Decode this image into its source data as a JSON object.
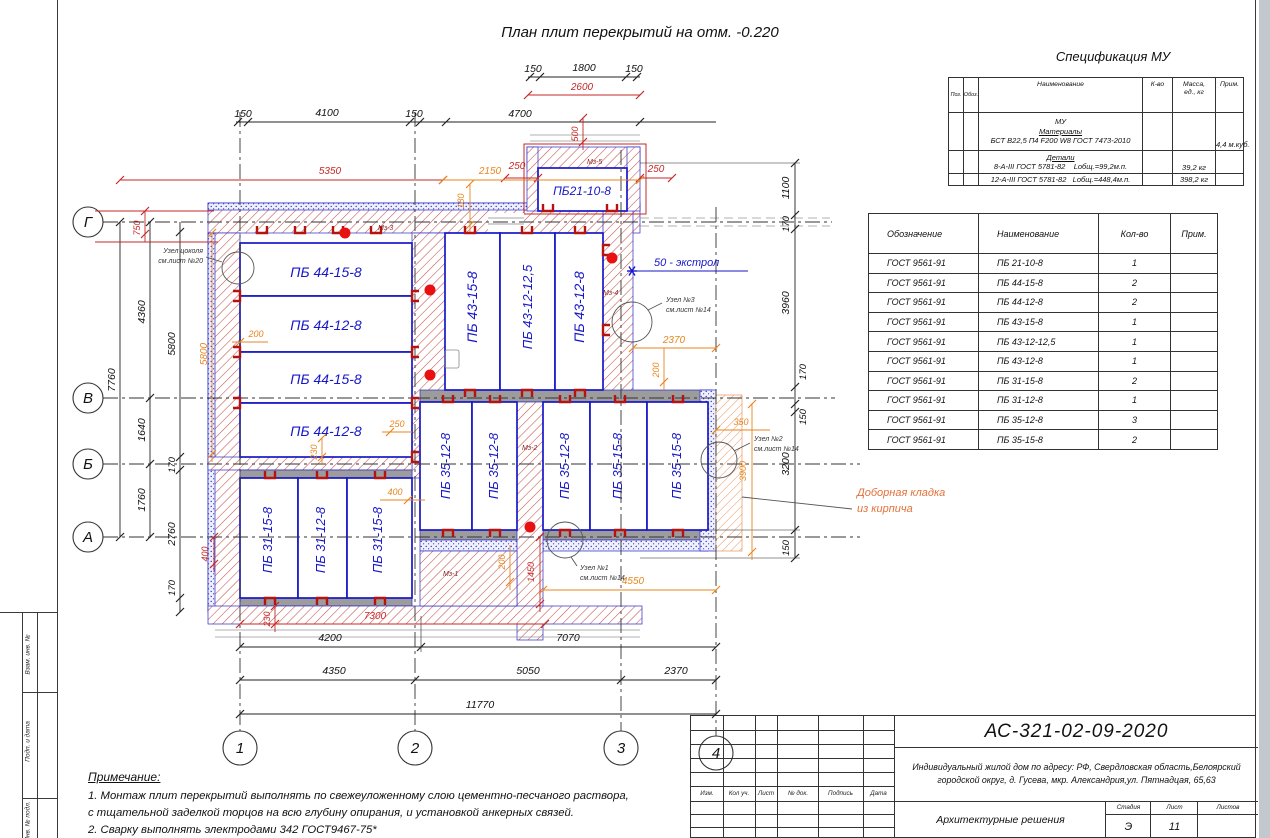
{
  "sheet": {
    "plan_title": "План плит перекрытий на отм. -0.220",
    "spec_title": "Спецификация МУ"
  },
  "colors": {
    "slab_blue": "#1717c9",
    "hatch_red": "#c4524a",
    "dim_red": "#c62828",
    "dim_orange": "#e8861e",
    "masonry_gray": "#9c9c9c"
  },
  "axes": {
    "h": [
      "Г",
      "В",
      "Б",
      "А"
    ],
    "v": [
      "1",
      "2",
      "3",
      "4"
    ]
  },
  "slabs": {
    "left": [
      "ПБ 44-15-8",
      "ПБ 44-12-8",
      "ПБ 44-15-8",
      "ПБ 44-12-8"
    ],
    "mid": [
      "ПБ 43-15-8",
      "ПБ 43-12-12,5",
      "ПБ 43-12-8"
    ],
    "top_bay": "ПБ21-10-8",
    "bottom_mid": [
      "ПБ 35-12-8",
      "ПБ 35-12-8",
      "ПБ 35-12-8",
      "ПБ 35-15-8",
      "ПБ 35-15-8"
    ],
    "bottom_left": [
      "ПБ 31-15-8",
      "ПБ 31-12-8",
      "ПБ 31-15-8"
    ]
  },
  "dims": {
    "bay150a": "150",
    "bay1800": "1800",
    "bay150b": "150",
    "bay2600": "2600",
    "bay500": "500",
    "m150a": "150",
    "m4100": "4100",
    "m150b": "150",
    "m4700": "4700",
    "red5350": "5350",
    "o2150": "2150",
    "red250a": "250",
    "red250b": "250",
    "o180": "180",
    "l7760": "7760",
    "l4360": "4360",
    "l1640": "1640",
    "l1760": "1760",
    "l5800": "5800",
    "l170a": "170",
    "l2760": "2760",
    "l170b": "170",
    "lo5800": "5800",
    "lr750": "750",
    "lr400": "400",
    "lo200": "200",
    "lo230": "230",
    "lo250": "250",
    "lo400": "400",
    "r1100": "1100",
    "r170a": "170",
    "r3960": "3960",
    "r170b": "170",
    "r150a": "150",
    "r3200": "3200",
    "r150b": "150",
    "ro2370": "2370",
    "ro200": "200",
    "ro350": "350",
    "ro3900": "3900",
    "rr250": "250",
    "br7300": "7300",
    "br230": "230",
    "br1450": "1450",
    "b4200": "4200",
    "b7070": "7070",
    "b4350": "4350",
    "b5050": "5050",
    "b2370": "2370",
    "b11770": "11770",
    "bo4550": "4550",
    "bo200": "200"
  },
  "ann": {
    "cokol1": "Узел цоколя",
    "cokol2": "см.лист №20",
    "n1a": "Узел №1",
    "n1b": "см.лист №14",
    "n2a": "Узел №2",
    "n2b": "см.лист №14",
    "n3a": "Узел №3",
    "n3b": "см.лист №14",
    "ekstrol": "50 - экстрол",
    "dob1": "Доборная кладка",
    "dob2": "из кирпича",
    "mz1": "Мз-1",
    "mz2": "Мз-2",
    "mz3": "Мз-3",
    "mz4": "Мз-4",
    "mz5": "Мз-5"
  },
  "spec_table": {
    "h_poz": "Поз.",
    "h_oboz": "Обоз.",
    "h_name": "Наименование",
    "h_qty": "К-во",
    "h_mass1": "Масса,",
    "h_mass2": "ед., кг",
    "h_note": "Прим.",
    "line_mu": "МУ",
    "line_materials": "Материалы",
    "line_concrete": "БСТ В22,5 П4 F200 W8 ГОСТ 7473-2010",
    "note_concrete": "4,4 м.куб.",
    "line_details": "Детали",
    "line_rebar8": "8-А-III ГОСТ 5781-82",
    "len8": "Lобщ.=99,2м.п.",
    "mass8": "39,2 кг",
    "line_rebar12": "12-А-III ГОСТ 5781-82",
    "len12": "Lобщ.=448,4м.п.",
    "mass12": "398,2 кг"
  },
  "plates_table": {
    "headers": [
      "Обозначение",
      "Наименование",
      "Кол-во",
      "Прим."
    ],
    "rows": [
      [
        "ГОСТ 9561-91",
        "ПБ 21-10-8",
        "1",
        ""
      ],
      [
        "ГОСТ 9561-91",
        "ПБ 44-15-8",
        "2",
        ""
      ],
      [
        "ГОСТ 9561-91",
        "ПБ 44-12-8",
        "2",
        ""
      ],
      [
        "ГОСТ 9561-91",
        "ПБ 43-15-8",
        "1",
        ""
      ],
      [
        "ГОСТ 9561-91",
        "ПБ 43-12-12,5",
        "1",
        ""
      ],
      [
        "ГОСТ 9561-91",
        "ПБ 43-12-8",
        "1",
        ""
      ],
      [
        "ГОСТ 9561-91",
        "ПБ 31-15-8",
        "2",
        ""
      ],
      [
        "ГОСТ 9561-91",
        "ПБ 31-12-8",
        "1",
        ""
      ],
      [
        "ГОСТ 9561-91",
        "ПБ 35-12-8",
        "3",
        ""
      ],
      [
        "ГОСТ 9561-91",
        "ПБ 35-15-8",
        "2",
        ""
      ]
    ]
  },
  "title_block": {
    "doc_number": "АС-321-02-09-2020",
    "project_line1": "Индивидуальный жилой дом по адресу: РФ, Свердловская область,Белоярский",
    "project_line2": "городской округ, д. Гусева, мкр. Александрия,ул. Пятнадцая, 65,63",
    "section": "Архитектурные решения",
    "col_izm": "Изм.",
    "col_kol": "Кол уч.",
    "col_list": "Лист",
    "col_ndok": "№ док.",
    "col_podp": "Подпись",
    "col_data": "Дата",
    "stage_label": "Стадия",
    "sheet_label": "Лист",
    "sheets_label": "Листов",
    "stage": "Э",
    "sheet": "11",
    "sheets": ""
  },
  "notes": {
    "title": "Примечание:",
    "line1": "1. Монтаж плит перекрытий выполнять по свежеуложенному слою цементно-песчаного раствора,",
    "line2": "с тщательной заделкой торцов на всю глубину опирания, и установкой анкерных связей.",
    "line3": "2. Сварку выполнять электродами 342 ГОСТ9467-75*"
  },
  "side_strip": {
    "s1": "Взам. инв. №",
    "s2": "Подп. и дата",
    "s3": "Инв. № подл."
  }
}
